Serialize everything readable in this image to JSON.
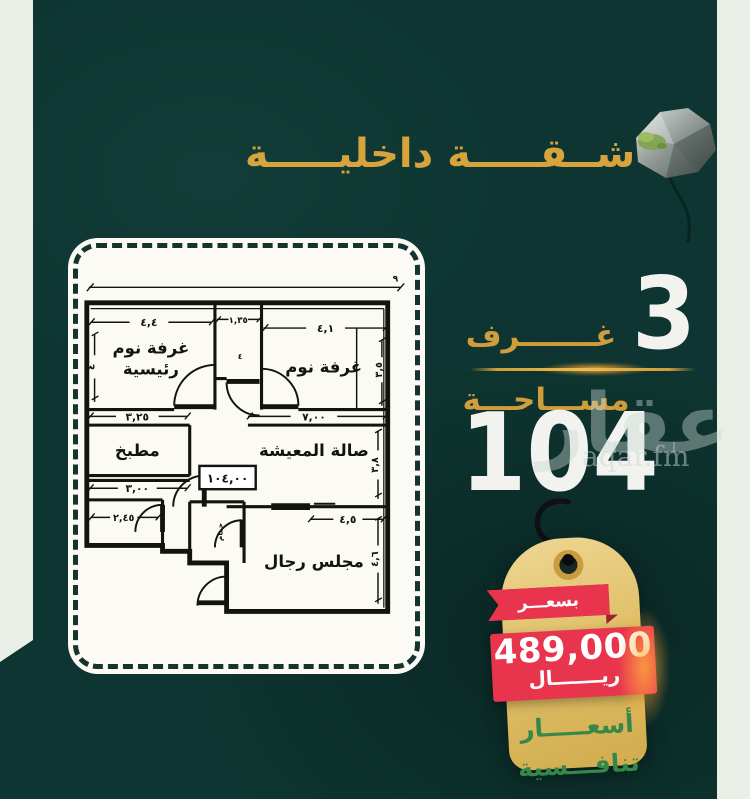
{
  "title": {
    "text": "شــقـــــة داخليـــــة"
  },
  "stats": {
    "rooms_value": "3",
    "rooms_label": "غـــــــرف",
    "area_label": "مســـاحـــة",
    "area_value": "104"
  },
  "watermark": {
    "arabic": "عقار",
    "latin": "aqar.fm"
  },
  "tag": {
    "ribbon": "بسعـــر",
    "amount": "489,000",
    "currency": "ريـــــــال",
    "note1": "أسعـــــار",
    "note2": "تنافـــسية"
  },
  "plan": {
    "rooms": {
      "master1": "غرفة نوم",
      "master2": "رئيسية",
      "bedroom": "غرفة نوم",
      "kitchen": "مطبخ",
      "living": "صالة المعيشة",
      "majlis": "مجلس رجال",
      "bath": "حمام"
    },
    "dims": {
      "overall": "٩",
      "master_top": "٤,٤",
      "master_left": "٤",
      "bath_top": "١,٣٥",
      "bedroom_top": "٤,١",
      "bedroom_right": "٣,٥",
      "kitchen_top": "٣,٢٥",
      "kitchen_bottom": "٣,٠٠",
      "living_top": "٧,٠٠",
      "living_right": "٣,٨",
      "bath2_top": "٢,٤٥",
      "majlis_top": "٤,٥",
      "majlis_right": "٤,٦",
      "area_box": "١٠٤,٠٠",
      "door": "٤"
    }
  },
  "colors": {
    "background": "#0e3531",
    "edge_strip": "#e9efe7",
    "gold": "#cf9d3b",
    "red": "#e8354d",
    "green": "#35884a",
    "tag_gold": "#ddbb60",
    "white": "#f2f3ee"
  }
}
